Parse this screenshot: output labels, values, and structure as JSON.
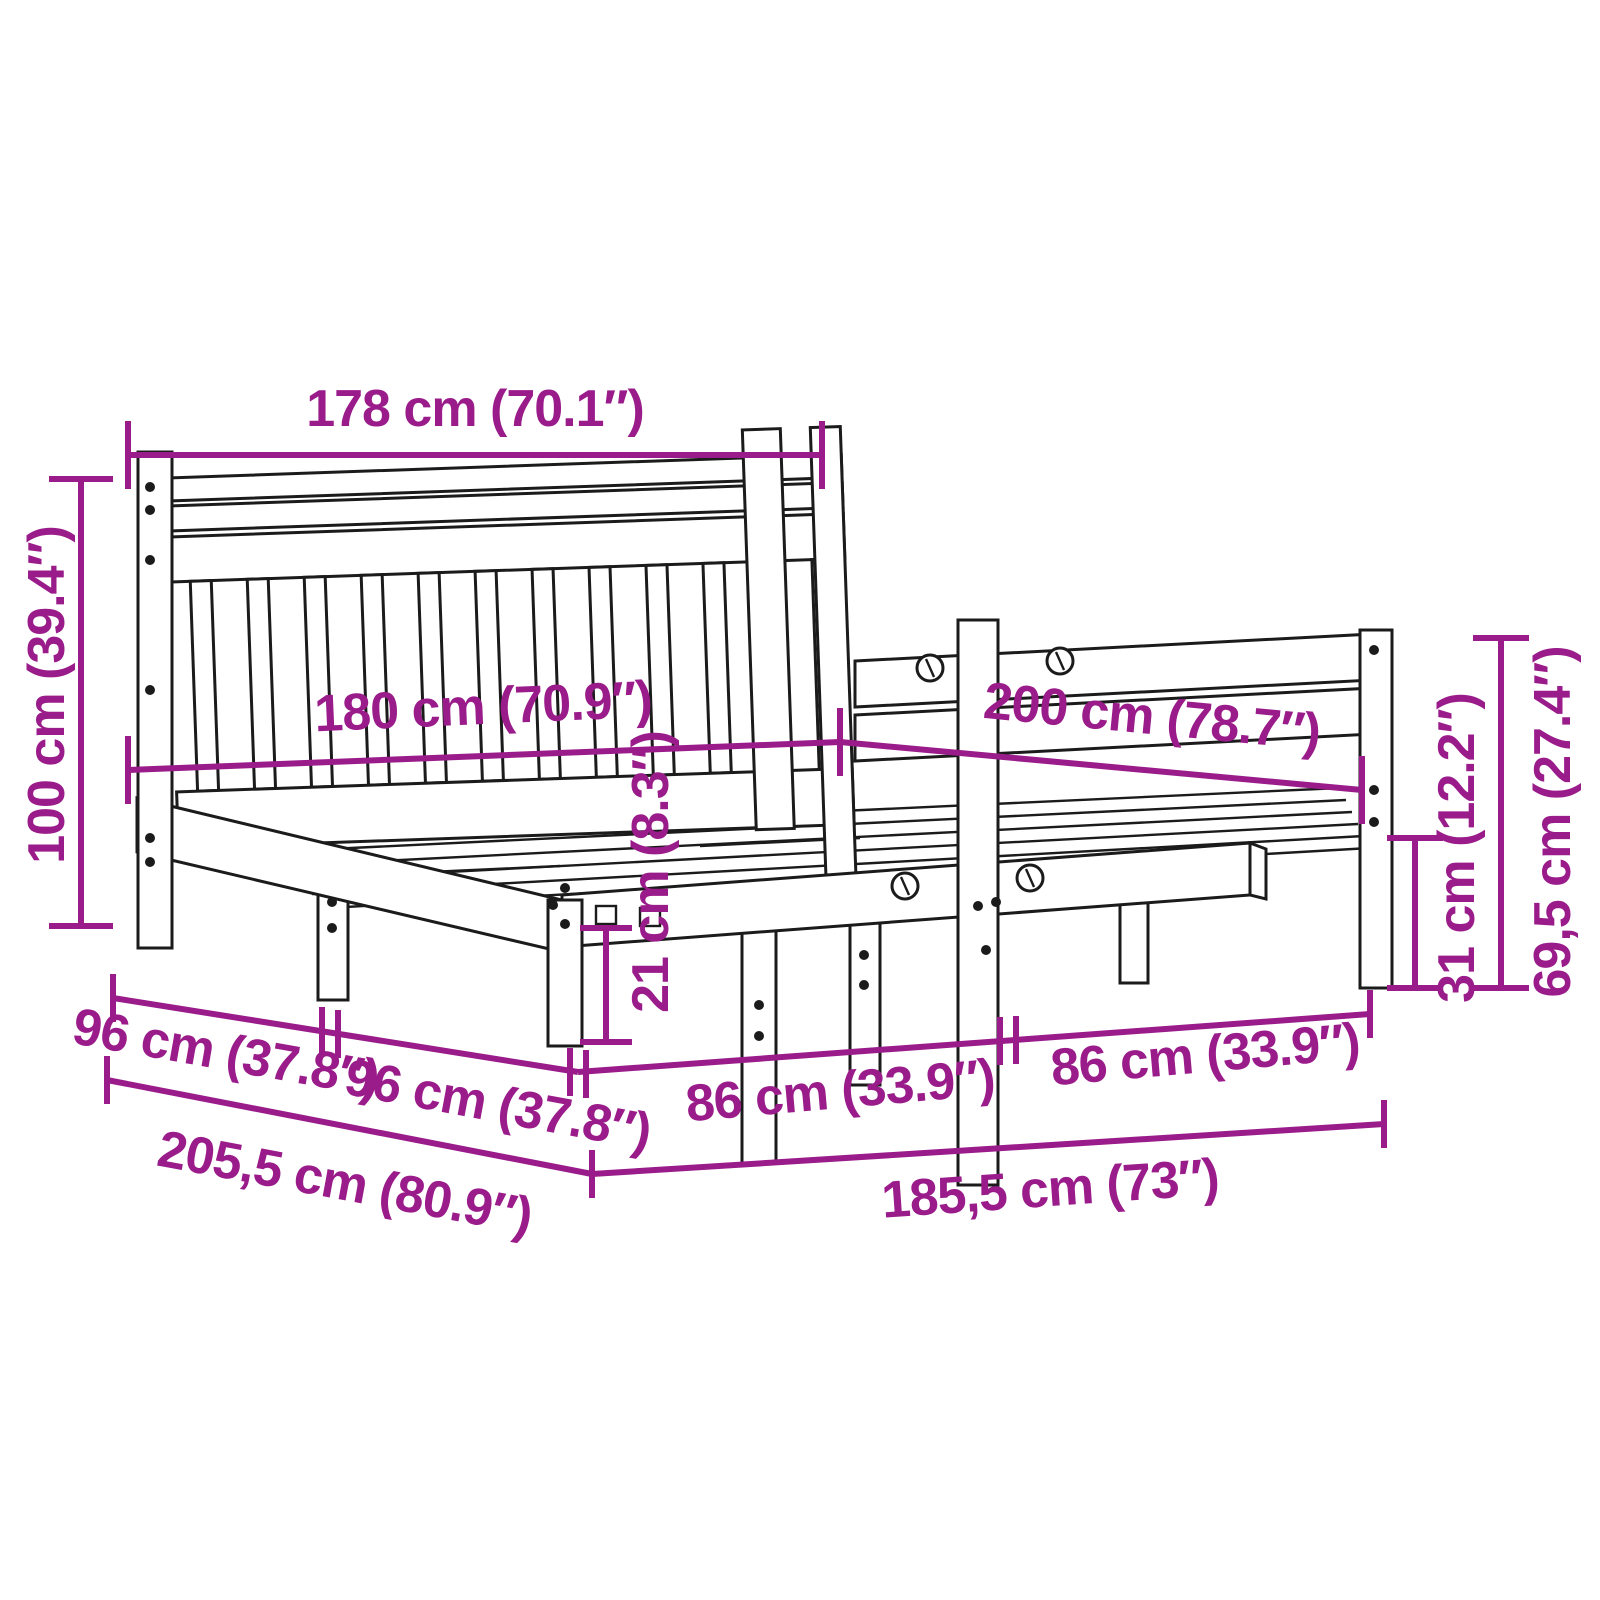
{
  "diagram": {
    "title": "bed-frame-dimension-diagram",
    "accent_color": "#9A1B8A",
    "line_color": "#1b1b1b",
    "background_color": "#ffffff",
    "dimensions": {
      "headboard_width": "178 cm (70.1″)",
      "headboard_height": "100 cm (39.4″)",
      "bed_width": "180 cm (70.9″)",
      "bed_length": "200 cm (78.7″)",
      "under_bed_clearance": "21 cm (8.3″)",
      "leg_spacing_side_1": "96 cm (37.8″)",
      "leg_spacing_side_2": "96 cm (37.8″)",
      "frame_total_length": "205,5 cm (80.9″)",
      "leg_spacing_front_1": "86 cm (33.9″)",
      "leg_spacing_front_2": "86 cm (33.9″)",
      "frame_total_width": "185,5 cm (73″)",
      "side_rail_height": "31 cm (12.2″)",
      "footboard_height": "69,5 cm (27.4″)"
    }
  }
}
